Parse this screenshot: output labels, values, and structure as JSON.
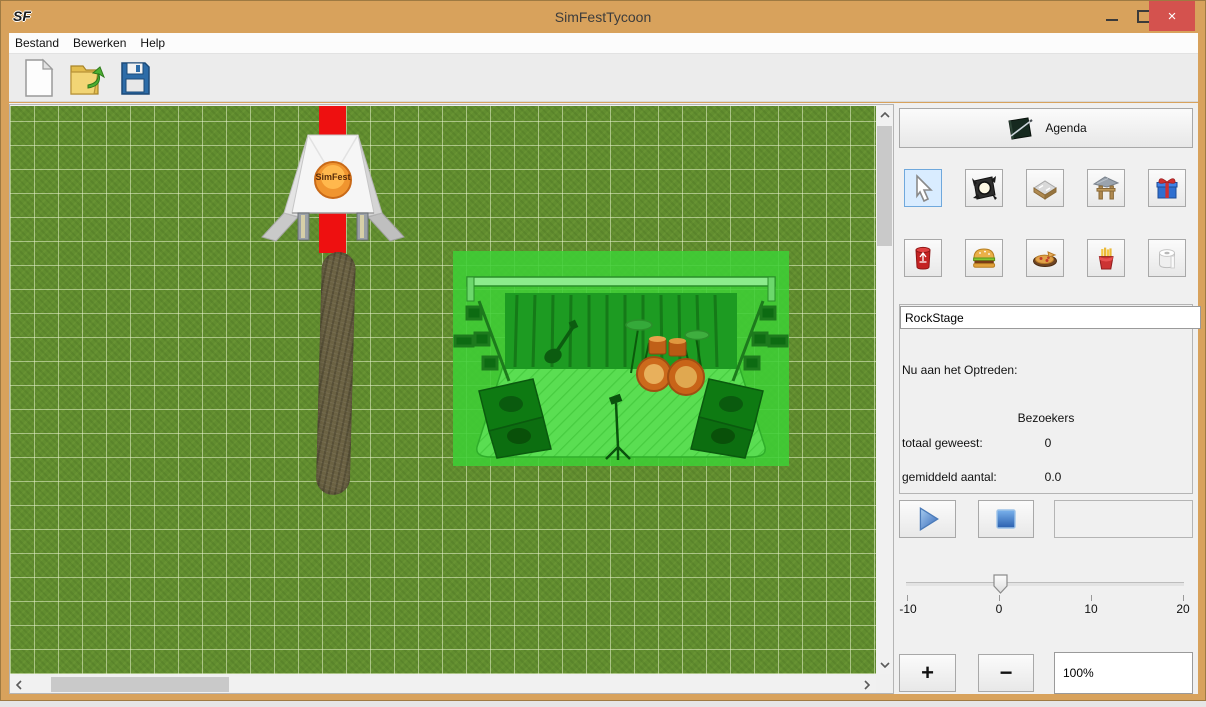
{
  "window": {
    "title": "SimFestTycoon",
    "app_icon_text": "SF",
    "close_glyph": "×"
  },
  "menu": {
    "items": [
      {
        "label": "Bestand"
      },
      {
        "label": "Bewerken"
      },
      {
        "label": "Help"
      }
    ]
  },
  "toolbar": {
    "buttons": [
      {
        "icon": "new-file-icon"
      },
      {
        "icon": "open-file-icon"
      },
      {
        "icon": "save-file-icon"
      }
    ]
  },
  "canvas": {
    "objects": [
      {
        "name": "festival-tent"
      },
      {
        "name": "red-carpet"
      },
      {
        "name": "dirt-path"
      },
      {
        "name": "rock-stage-selected"
      }
    ],
    "tent_logo_text": "SimFest"
  },
  "panel": {
    "agenda": {
      "label": "Agenda",
      "icon": "agenda-book-icon"
    },
    "tools": {
      "row1": [
        {
          "icon": "select-cursor-icon",
          "selected": true
        },
        {
          "icon": "spotlight-icon",
          "selected": false
        },
        {
          "icon": "road-tile-icon",
          "selected": false
        },
        {
          "icon": "entrance-gate-icon",
          "selected": false
        },
        {
          "icon": "gift-icon",
          "selected": false
        }
      ],
      "row2": [
        {
          "icon": "trash-can-icon",
          "selected": false
        },
        {
          "icon": "hamburger-icon",
          "selected": false
        },
        {
          "icon": "pizza-icon",
          "selected": false
        },
        {
          "icon": "fries-icon",
          "selected": false
        },
        {
          "icon": "toilet-paper-icon",
          "selected": false
        }
      ]
    },
    "stage_info": {
      "name_value": "RockStage",
      "now_performing_label": "Nu aan het Optreden:",
      "visitors_header": "Bezoekers",
      "total_label": "totaal geweest:",
      "total_value": "0",
      "average_label": "gemiddeld aantal:",
      "average_value": "0.0"
    },
    "transport": {
      "play_icon": "play-icon",
      "stop_icon": "stop-icon"
    },
    "speed_slider": {
      "min": -10,
      "max": 20,
      "value": 0,
      "tick_labels": [
        "-10",
        "0",
        "10",
        "20"
      ]
    },
    "zoom": {
      "in_label": "+",
      "out_label": "−",
      "level_value": "100%"
    }
  },
  "colors": {
    "titlebar_orange": "#d8a25c",
    "close_red": "#d4524e",
    "grass_green": "#618d2f",
    "grid_line": "#e8f3ce",
    "selection_green": "#3ecf35",
    "carpet_red": "#ee1010",
    "path_brown": "#6b6243",
    "selected_tool_blue": "#d9ecff"
  }
}
